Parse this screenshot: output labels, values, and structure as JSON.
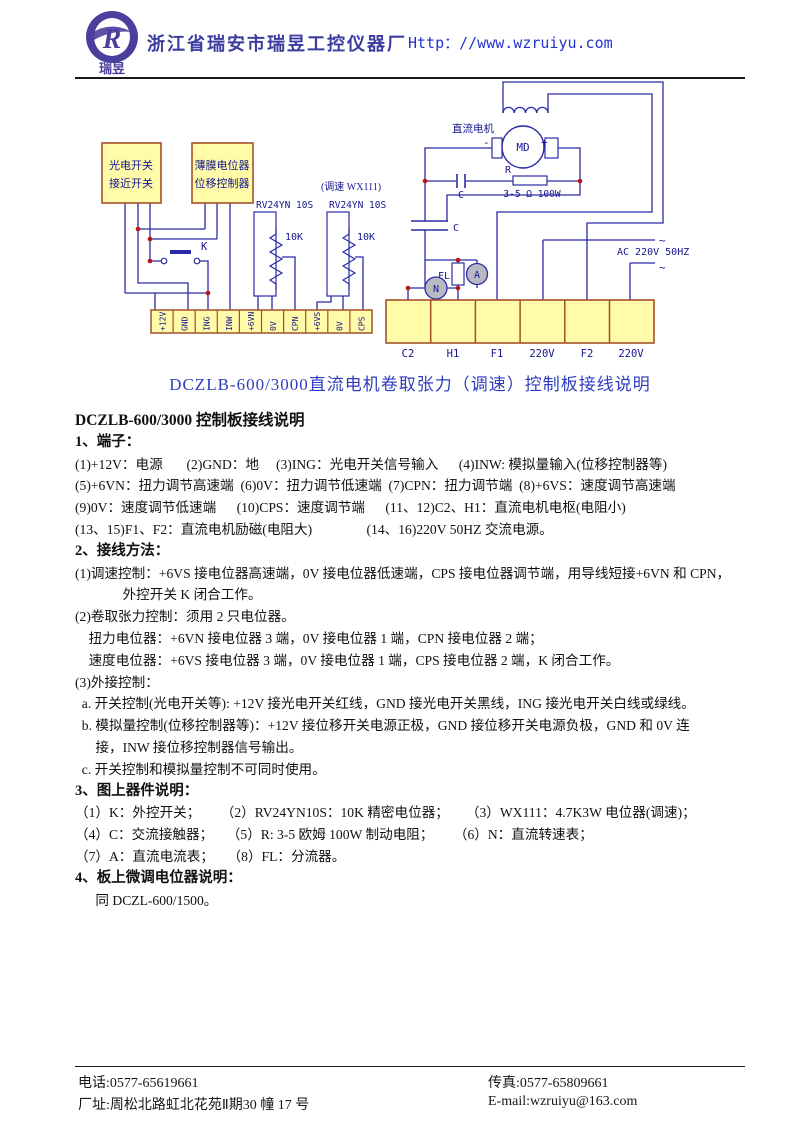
{
  "header": {
    "company": "浙江省瑞安市瑞昱工控仪器厂",
    "url": "Http：//www.wzruiyu.com",
    "logo_text": "瑞昱",
    "logo_letter": "R"
  },
  "diagram": {
    "caption": "DCZLB-600/3000直流电机卷取张力（调速）控制板接线说明",
    "box1_line1": "光电开关",
    "box1_line2": "接近开关",
    "box2_line1": "薄膜电位器",
    "box2_line2": "位移控制器",
    "speed_label": "(调速  WX111)",
    "pot1_model": "RV24YN 10S",
    "pot2_model": "RV24YN 10S",
    "pot1_value": "10K",
    "pot2_value": "10K",
    "switch_label": "K",
    "motor_label": "直流电机",
    "motor_text": "MD",
    "plus": "+",
    "minus": "-",
    "cap1_label": "C",
    "cap2_label": "C",
    "r_label": "R",
    "r_value": "3-5 Ω  100W",
    "fl_label": "FL",
    "ammeter": "A",
    "tach": "N",
    "ac_label": "AC 220V  50HZ",
    "tilde_top": "~",
    "tilde_bottom": "~",
    "terminals_left": [
      "+12V",
      "GND",
      "ING",
      "INW",
      "+6VN",
      "0V",
      "CPN",
      "+6VS",
      "0V",
      "CPS"
    ],
    "terminals_right": [
      "C2",
      "H1",
      "F1",
      "220V",
      "F2",
      "220V"
    ]
  },
  "content": {
    "heading": "DCZLB-600/3000 控制板接线说明",
    "s1_title": "1、端子：",
    "s1_lines": [
      "(1)+12V：电源       (2)GND：地     (3)ING：光电开关信号输入      (4)INW: 模拟量输入(位移控制器等)",
      "(5)+6VN：扭力调节高速端  (6)0V：扭力调节低速端  (7)CPN：扭力调节端  (8)+6VS：速度调节高速端",
      "(9)0V：速度调节低速端      (10)CPS：速度调节端      (11、12)C2、H1：直流电机电枢(电阻小)",
      "(13、15)F1、F2：直流电机励磁(电阻大)                (14、16)220V 50HZ 交流电源。"
    ],
    "s2_title": "2、接线方法：",
    "s2_lines": [
      "(1)调速控制：+6VS 接电位器高速端，0V 接电位器低速端，CPS 接电位器调节端，用导线短接+6VN 和 CPN，",
      "              外控开关 K 闭合工作。",
      "(2)卷取张力控制：须用 2 只电位器。",
      "    扭力电位器：+6VN 接电位器 3 端，0V 接电位器 1 端，CPN 接电位器 2 端；",
      "    速度电位器：+6VS 接电位器 3 端，0V 接电位器 1 端，CPS 接电位器 2 端，K 闭合工作。",
      "(3)外接控制：",
      "  a. 开关控制(光电开关等): +12V 接光电开关红线，GND 接光电开关黑线，ING 接光电开关白线或绿线。",
      "  b. 模拟量控制(位移控制器等)：+12V 接位移开关电源正极，GND 接位移开关电源负极，GND 和 0V 连",
      "      接，INW 接位移控制器信号输出。",
      "  c. 开关控制和模拟量控制不可同时使用。"
    ],
    "s3_title": "3、图上器件说明：",
    "s3_lines": [
      "（1）K：外控开关；      （2）RV24YN10S：10K 精密电位器；     （3）WX111：4.7K3W 电位器(调速)；",
      "（4）C：交流接触器；    （5）R: 3-5 欧姆 100W 制动电阻；      （6）N：直流转速表；",
      "（7）A：直流电流表；    （8）FL：分流器。"
    ],
    "s4_title": "4、板上微调电位器说明：",
    "s4_line": "      同 DCZL-600/1500。"
  },
  "footer": {
    "phone": "电话:0577-65619661",
    "fax": "传真:0577-65809661",
    "address": "厂址:周松北路虹北花苑Ⅱ期30 幢 17 号",
    "email": "E-mail:wzruiyu@163.com"
  }
}
